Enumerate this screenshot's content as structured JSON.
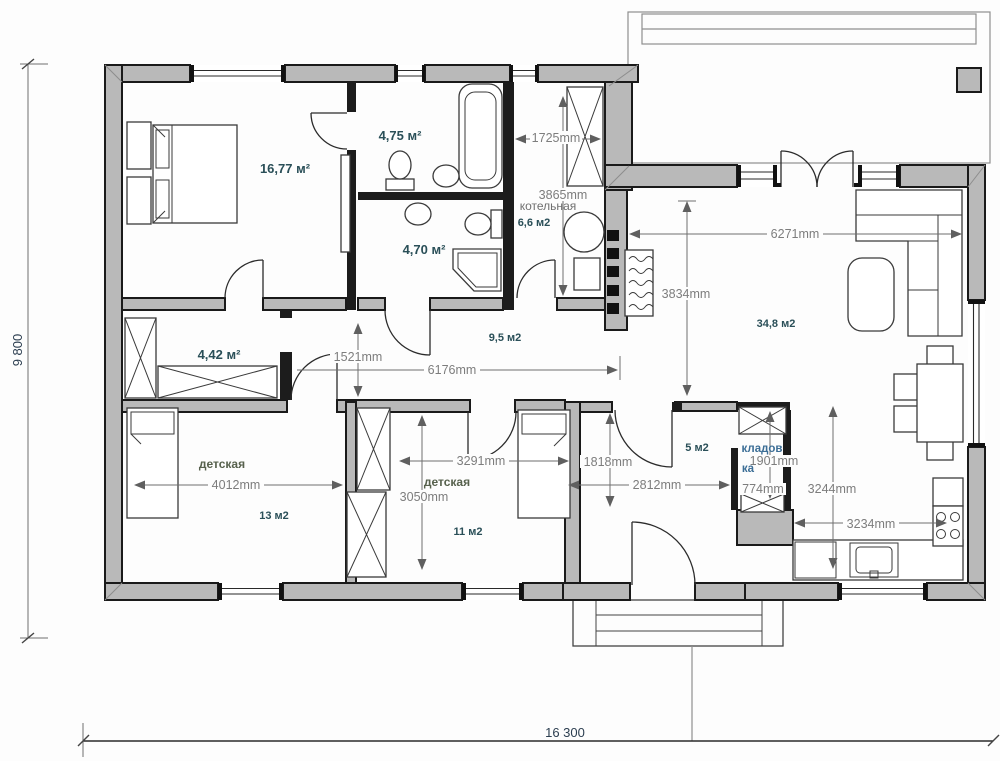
{
  "colors": {
    "wall_fill": "#b9b9b9",
    "wall_stroke": "#1a1a1a",
    "interior_wall": "#1c1c1c",
    "dimension_text": "#7d7d7d",
    "area_text": "#2a4f58",
    "room_name_text": "#57614d",
    "pantry_text": "#3c6e96",
    "background": "#fdfdfd"
  },
  "labels": {
    "rooms": {
      "bedroom_area": "16,77 м²",
      "bath1_area": "4,75 м²",
      "bath2_area": "4,70 м²",
      "wardrobe_area": "4,42 м²",
      "boiler_name": "котельная",
      "boiler_area": "6,6 м2",
      "hallway_area": "9,5 м2",
      "living_area": "34,8 м2",
      "kids1_name": "детская",
      "kids1_area": "13 м2",
      "kids2_name": "детская",
      "kids2_area": "11 м2",
      "hall_area": "5 м2",
      "pantry_name_1": "кладов",
      "pantry_name_2": "ка"
    },
    "dims": {
      "boiler_w": "1725mm",
      "boiler_h": "3865mm",
      "living_w": "6271mm",
      "living_h": "3834mm",
      "corridor_w": "1521mm",
      "corridor_len": "6176mm",
      "kids1_w": "4012mm",
      "kids2_w": "3291mm",
      "kids2_h": "3050mm",
      "hall_h": "1818mm",
      "hall_w": "2812mm",
      "pantry_h": "1901mm",
      "pantry_w": "774mm",
      "kitchen_h": "3244mm",
      "kitchen_w": "3234mm",
      "overall_h": "9 800",
      "overall_w": "16 300"
    }
  }
}
